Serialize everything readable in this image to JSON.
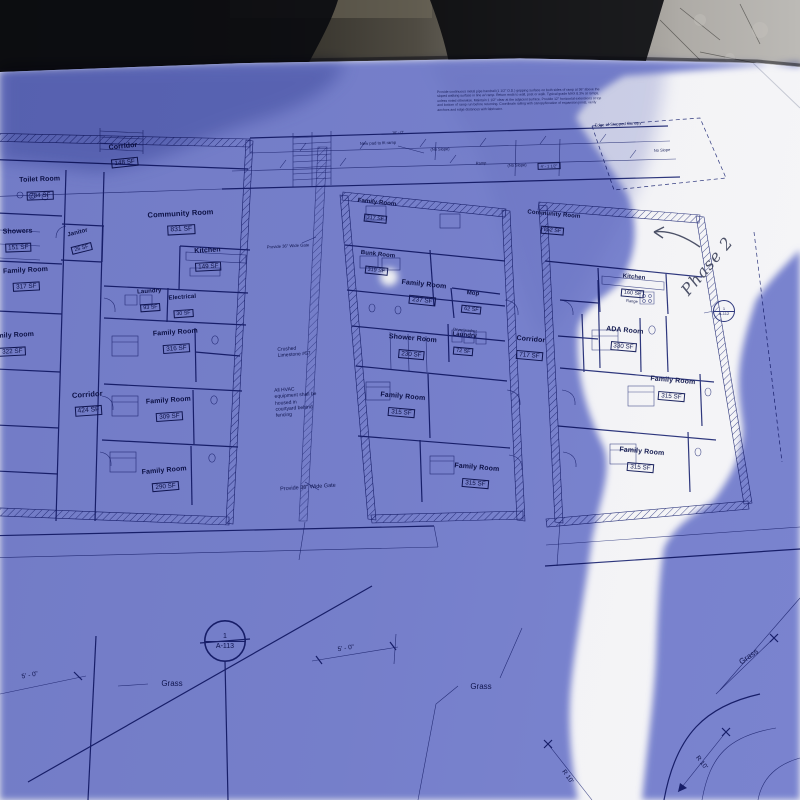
{
  "rooms": [
    {
      "name": "Corridor",
      "area": "148 SF"
    },
    {
      "name": "Toilet Room",
      "area": "234 SF"
    },
    {
      "name": "Janitor",
      "area": "26 SF"
    },
    {
      "name": "Showers",
      "area": "151 SF"
    },
    {
      "name": "Community Room",
      "area": "831 SF"
    },
    {
      "name": "Kitchen",
      "area": "149 SF"
    },
    {
      "name": "Laundry",
      "area": "93 SF"
    },
    {
      "name": "Electrical",
      "area": "30 SF"
    },
    {
      "name": "Family Room",
      "area": "317 SF"
    },
    {
      "name": "Family Room",
      "area": "322 SF"
    },
    {
      "name": "Family Room",
      "area": "316 SF"
    },
    {
      "name": "Corridor",
      "area": "424 SF"
    },
    {
      "name": "Family Room",
      "area": "309 SF"
    },
    {
      "name": "Family Room",
      "area": "290 SF"
    },
    {
      "name": "Family Room",
      "area": "317 SF"
    },
    {
      "name": "Bunk Room",
      "area": "319 SF"
    },
    {
      "name": "Family Room",
      "area": "237 SF"
    },
    {
      "name": "Mop",
      "area": "62 SF"
    },
    {
      "name": "Shower Room",
      "area": "230 SF"
    },
    {
      "name": "Laundry",
      "area": "72 SF",
      "sub": "Dryer/washer"
    },
    {
      "name": "Corridor",
      "area": "717 SF"
    },
    {
      "name": "Family Room",
      "area": "315 SF"
    },
    {
      "name": "Family Room",
      "area": "315 SF"
    },
    {
      "name": "Community Room",
      "area": "852 SF"
    },
    {
      "name": "Kitchen",
      "area": "160 SF",
      "sub": "Range"
    },
    {
      "name": "ADA Room",
      "area": "330 SF"
    },
    {
      "name": "Family Room",
      "area": "315 SF"
    },
    {
      "name": "Family Room",
      "area": "315 SF"
    }
  ],
  "notes": {
    "general": "Provide continuous metal pipe handrail (1 1/2\" O.D.) gripping surface on both sides of ramp at 36\" above the sloped walking surface in line w/ ramp. Return ends to wall, post or walk. Typical grade MAX 8.3% at ramps, unless noted otherwise. Maintain 1 1/2\" clear at the adjacent surface. Provide 12\" horizontal extensions at top and bottom of ramp run before returning. Coordinate railing with canopy/location of expansion joints, verify anchors and edge distances with fabricator.",
    "gate_top": "Provide 36\" Wide Gate",
    "gate_bottom": "Provide 36\" Wide Gate",
    "limestone": "Crushed\nLimestone #57",
    "hvac": "All HVAC\nequipment shall be\nhoused in\ncourtyard behind\nfencing",
    "new_pad": "New pad to fit ramp",
    "canopy_edge": "Edge of Stepped Canopy",
    "no_slope": "(No Slope)",
    "no_slope_plain": "No Slope",
    "ramp": "Ramp",
    "dim_box": "4' - 1 1/2\"",
    "dim_16": "16' - 0\""
  },
  "site": {
    "grass": "Grass",
    "dim_5_0": "5' - 0\"",
    "r10": "R 10'",
    "callout_113": {
      "top": "1",
      "bottom": "A-113"
    },
    "callout_112": {
      "top": "1",
      "bottom": "A-112"
    },
    "handwriting": "Phase 2"
  },
  "colors": {
    "plan_line": "#2e377d",
    "shade_blue": "#7e88d5",
    "lit_paper": "#f3f3f6",
    "stone_dark": "#1f1d19",
    "stone_light": "#bcbab6",
    "silhouette": "#0b0c10"
  }
}
